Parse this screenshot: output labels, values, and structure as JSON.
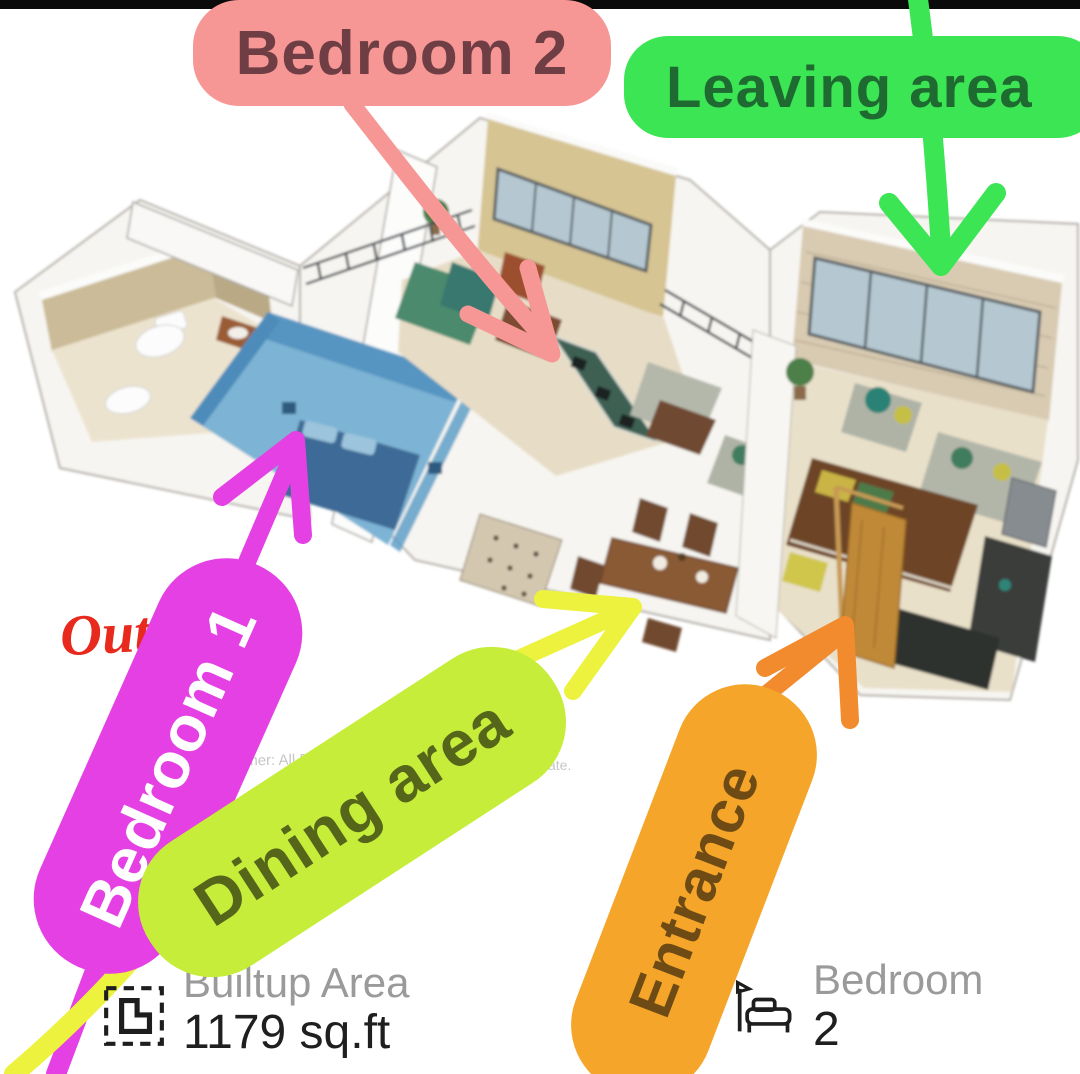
{
  "meta": {
    "description": "Annotated 3D apartment floor plan promo image",
    "top_bar_color": "#0a0a0a",
    "background": "#ffffff"
  },
  "labels": {
    "bedroom2": {
      "text": "Bedroom 2",
      "bg": "#F79795",
      "color": "#6E3E44"
    },
    "leaving": {
      "text": "Leaving area",
      "bg": "#3BE554",
      "color": "#1E6A30"
    },
    "bedroom1": {
      "text": "Bedroom 1",
      "bg": "#E440E4",
      "color": "#FFFFFF"
    },
    "dining": {
      "text": "Dining area",
      "bg": "#C6ED3A",
      "color": "#55661A"
    },
    "entrance": {
      "text": "Entrance",
      "bg": "#F5A62A",
      "color": "#6E4B14"
    },
    "out_note": {
      "text": "Out",
      "color": "#E8291D"
    }
  },
  "arrows": {
    "pink": {
      "color": "#F79795",
      "target": "bedroom-2-room"
    },
    "green": {
      "color": "#3BE554",
      "target": "living-area-room"
    },
    "magenta": {
      "color": "#E440E4",
      "target": "bedroom-1-room"
    },
    "yellow": {
      "color": "#EDF23F",
      "target": "dining-area"
    },
    "orange": {
      "color": "#F28A2E",
      "target": "entrance-door"
    }
  },
  "watermark": {
    "fragment_left": "isclaimer: All Dimen",
    "fragment_right": "ate."
  },
  "stats": {
    "builtup": {
      "label": "Builtup Area",
      "value": "1179 sq.ft",
      "icon": "area-outline-icon"
    },
    "bedroom": {
      "label": "Bedroom",
      "value": "2",
      "icon": "bed-icon"
    }
  },
  "floor_plan": {
    "type": "3d-isometric-render",
    "palette": {
      "wall_white": "#f7f5f1",
      "wall_edge": "#b3afa8",
      "bathroom_wall": "#cbbb98",
      "floor_cream": "#e8dfc8",
      "bedroom1_blue_wall": "#5795c1",
      "bedroom1_blue_floor": "#7db3d4",
      "bedroom1_bed": "#3c6b96",
      "tan_wall": "#d6c493",
      "brick_wall": "#d8cbb2",
      "window_glass": "#b5c8d1",
      "window_frame": "#565d62",
      "kitchen_teal": "#3c6053",
      "sofa_gray": "#b2b6a9",
      "wood_dark": "#6d4427",
      "wood_door": "#c08938",
      "cushion_green": "#3f7d5f",
      "cushion_yellow": "#c6bf45"
    }
  }
}
